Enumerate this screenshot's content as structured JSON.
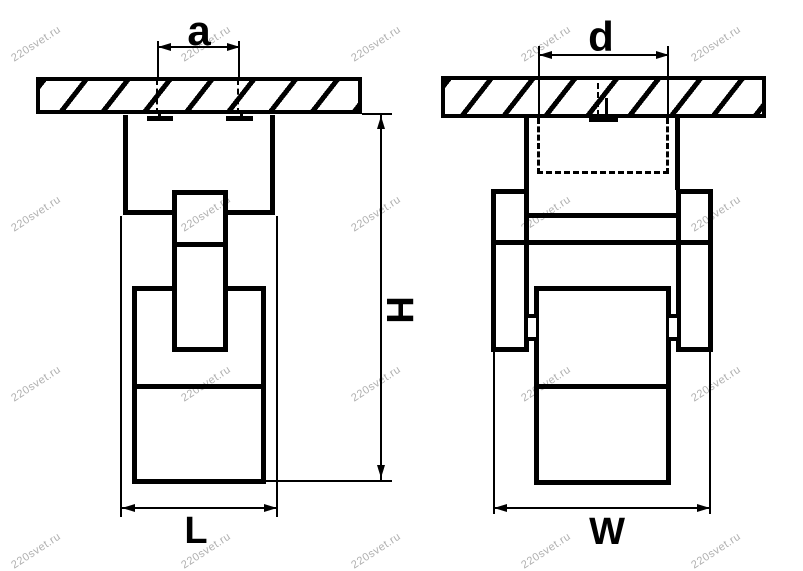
{
  "watermark": {
    "text": "220svet.ru"
  },
  "drawing": {
    "kind": "technical dimension drawing, two orthographic views of a ceiling-mounted spot light",
    "line_color": "#000000",
    "background_color": "#ffffff",
    "views": [
      {
        "id": "front",
        "dimension_labels": [
          "a",
          "L",
          "H"
        ]
      },
      {
        "id": "side",
        "dimension_labels": [
          "d",
          "W"
        ]
      }
    ]
  },
  "labels": {
    "a": "a",
    "d": "d",
    "H": "H",
    "L": "L",
    "W": "W"
  }
}
